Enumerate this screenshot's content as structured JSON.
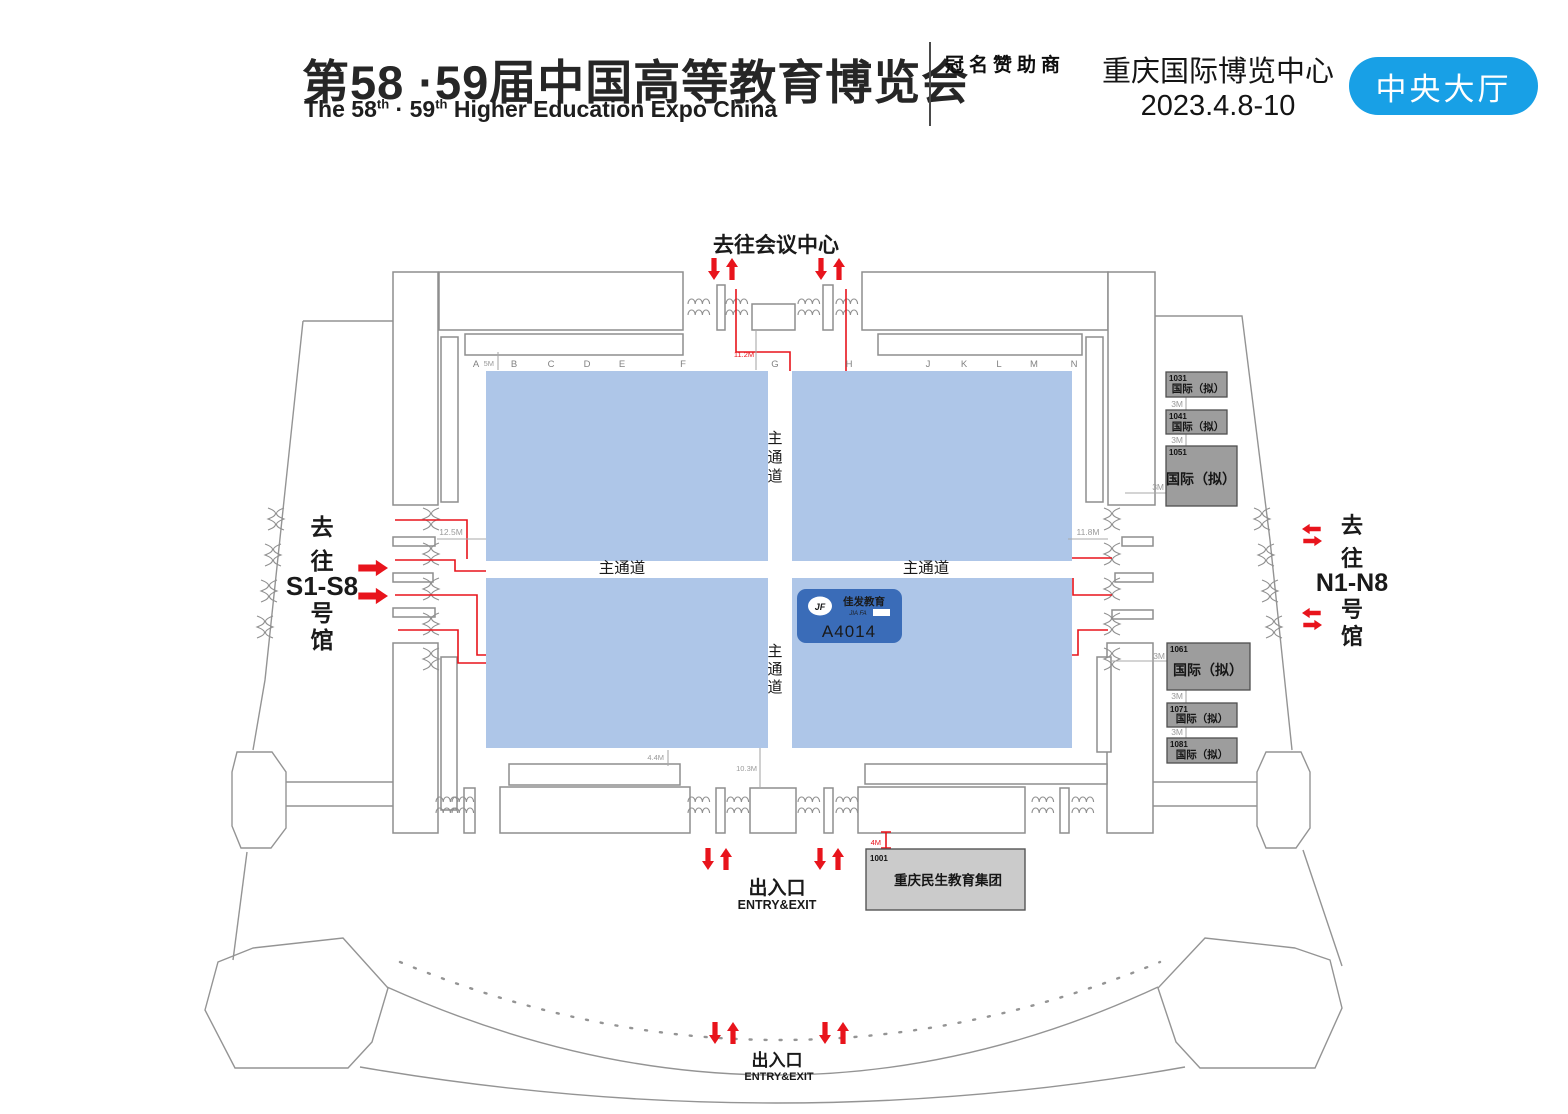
{
  "header": {
    "title_zh": "第58 ·59届中国高等教育博览会",
    "title_en_p1": "The 58",
    "title_en_sup1": "th",
    "title_en_p2": " · 59",
    "title_en_sup2": "th",
    "title_en_p3": " Higher Education Expo China",
    "sponsor_label": "冠名赞助商",
    "venue": "重庆国际博览中心",
    "dates": "2023.4.8-10",
    "hall_badge": "中央大厅"
  },
  "map": {
    "to_conference": "去往会议中心",
    "aisle_h": "主通道",
    "aisle_v": [
      "主",
      "通",
      "道"
    ],
    "to_s": [
      "去",
      "往",
      "S1-S8",
      "号",
      "馆"
    ],
    "to_n": [
      "去",
      "往",
      "N1-N8",
      "号",
      "馆"
    ],
    "columns": [
      "A",
      "B",
      "C",
      "D",
      "E",
      "F",
      "G",
      "H",
      "J",
      "K",
      "L",
      "M",
      "N"
    ],
    "entry_exit_zh": "出入口",
    "entry_exit_en": "ENTRY&EXIT",
    "dims": {
      "m5": "5M",
      "m112": "11.2M",
      "m125": "12.5M",
      "m118": "11.8M",
      "m44": "4.4M",
      "m103": "10.3M",
      "m4": "4M",
      "m3": "3M"
    },
    "booths": {
      "a4014": {
        "id": "A4014",
        "brand_zh": "佳发教育",
        "brand_en": "JIA FA",
        "logo_initials": "JF"
      },
      "intl": [
        {
          "no": "1031",
          "label": "国际（拟）"
        },
        {
          "no": "1041",
          "label": "国际（拟）"
        },
        {
          "no": "1051",
          "label": "国际（拟）"
        },
        {
          "no": "1061",
          "label": "国际（拟）"
        },
        {
          "no": "1071",
          "label": "国际（拟）"
        },
        {
          "no": "1081",
          "label": "国际（拟）"
        }
      ],
      "minsheng": {
        "no": "1001",
        "label": "重庆民生教育集团"
      }
    },
    "colors": {
      "zone_blue": "#aec6e8",
      "booth_blue": "#3a6cb8",
      "badge_blue": "#18a0e6",
      "red": "#e8141c",
      "booth_gray": "#9d9d9d"
    }
  }
}
